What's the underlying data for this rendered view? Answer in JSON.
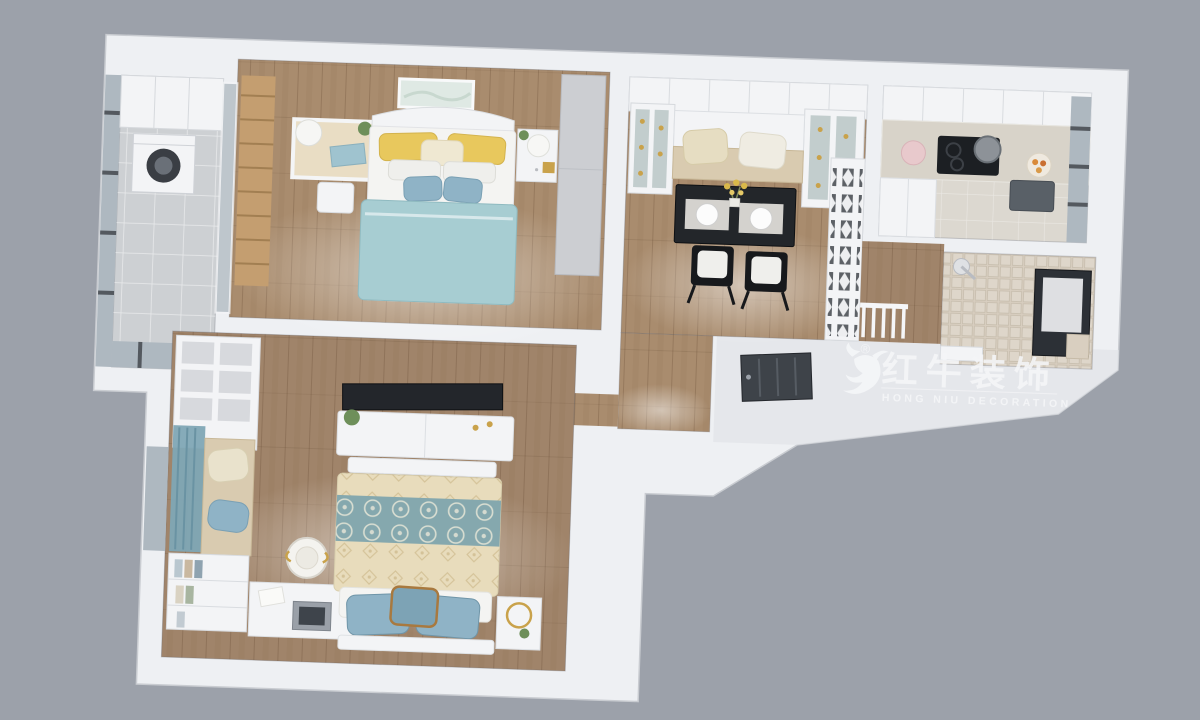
{
  "watermark": {
    "cn": "红牛装饰",
    "en": "HONG NIU DECORATION",
    "registered": "®",
    "logo_icon": "bull-logo"
  },
  "palette": {
    "background": "#9CA1AA",
    "wall": "#EEF0F3",
    "wall_shade": "#E2E4E8",
    "wood": "#A98C6E",
    "wood2": "#A0846A",
    "tile_gray": "#CDD0D3",
    "kitchen_floor": "#DCD8D0",
    "counter": "#D8D3C9",
    "mosaic": "#D8CEC0",
    "glass": "#AEB8C0",
    "white_furniture": "#F3F4F6",
    "wardrobe": "#CCCED2",
    "ladder_wood": "#C49E70",
    "duvet_blue": "#A7CDD2",
    "pillow_yellow": "#E8C85D",
    "pillow_blue": "#8FB3C6",
    "damask_cream": "#E8DCBC",
    "damask_teal": "#85A8AE",
    "bench_cushion": "#D9CBB0",
    "table_black": "#23262A",
    "chair_black": "#17191C",
    "door_dark": "#3E4349",
    "curtain_blue": "#7FA6B5",
    "gold": "#C9A24B",
    "plant_green": "#6E8F5A",
    "washer_drum": "#3A3E44",
    "logo_white": "#F5F6F8"
  },
  "rooms": [
    {
      "id": "balcony"
    },
    {
      "id": "master-bedroom"
    },
    {
      "id": "dining-room"
    },
    {
      "id": "kitchen"
    },
    {
      "id": "bathroom"
    },
    {
      "id": "hallway"
    },
    {
      "id": "entry"
    },
    {
      "id": "second-bedroom"
    }
  ]
}
